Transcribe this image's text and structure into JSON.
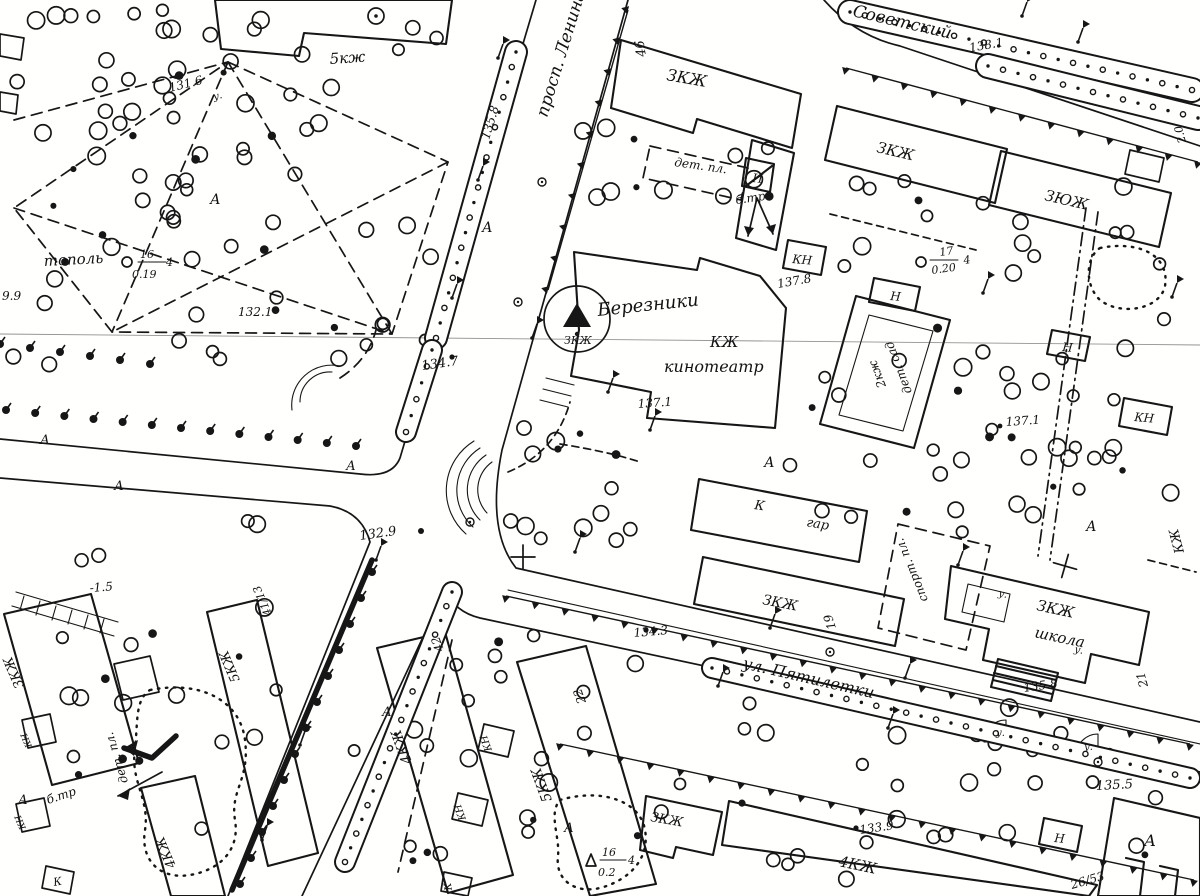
{
  "map": {
    "kind": "scanned topographic city plan (black ink on white paper)",
    "city": "Березники",
    "ink_color": "#161616",
    "paper_color": "#fffffe",
    "streets": [
      "просп. Ленина",
      "Советский",
      "ул. Пятилетки"
    ],
    "landmarks": [
      "КЖ кинотеатр «Березники»",
      "ЗКЖ школа",
      "2кж дет. сад",
      "К гар",
      "дет. пл.",
      "спорт. пл.",
      "б.тр",
      "тополь"
    ],
    "house_numbers": [
      "46",
      "19",
      "21",
      "22",
      "42",
      "41/13",
      "26/53"
    ],
    "spot_elevations": [
      "131.6",
      "132.1",
      "132.9",
      "133.9",
      "134.3",
      "134.7",
      "135.5",
      "135.8",
      "135.8",
      "137.1",
      "137.1",
      "137.8",
      "138.1"
    ],
    "tree_notations": [
      "тополь 16/0.19 4",
      "17/0.20 4",
      "16/0.2 4"
    ],
    "labels": [
      {
        "t": "просп. Ленина",
        "x": 547,
        "y": 118,
        "r": -73,
        "s": 17,
        "n": "street-label-prosp-lenina"
      },
      {
        "t": "Советский",
        "x": 852,
        "y": 16,
        "r": 13,
        "s": 17,
        "n": "street-label-sovetskiy"
      },
      {
        "t": "ул. Пятилетки",
        "x": 742,
        "y": 668,
        "r": 13,
        "s": 16,
        "n": "street-label-ul-pyatiletki"
      },
      {
        "t": "Березники",
        "x": 598,
        "y": 316,
        "r": -6,
        "s": 18,
        "n": "cinema-name-label"
      },
      {
        "t": "КЖ",
        "x": 710,
        "y": 347,
        "r": 0,
        "s": 15,
        "n": "cinema-code-label"
      },
      {
        "t": "кинотеатр",
        "x": 664,
        "y": 372,
        "r": 0,
        "s": 16,
        "n": "cinema-label"
      },
      {
        "t": "ЗКЖ",
        "x": 564,
        "y": 344,
        "r": 0,
        "s": 11,
        "n": "geodetic-point-label"
      },
      {
        "t": "137.1",
        "x": 638,
        "y": 408,
        "r": -4,
        "s": 12,
        "n": "spot-elevation"
      },
      {
        "t": "5кж",
        "x": 330,
        "y": 64,
        "r": -4,
        "s": 15,
        "n": "building-code"
      },
      {
        "t": "131.6",
        "x": 170,
        "y": 92,
        "r": -14,
        "s": 12,
        "n": "spot-elevation"
      },
      {
        "t": "у.",
        "x": 214,
        "y": 100,
        "r": -14,
        "s": 10,
        "n": "surface-mark"
      },
      {
        "t": "тополь",
        "x": 44,
        "y": 266,
        "r": -3,
        "s": 15,
        "n": "tree-species-label"
      },
      {
        "t": "16",
        "x": 140,
        "y": 258,
        "r": 0,
        "s": 11,
        "n": "tree-height"
      },
      {
        "t": "0.19",
        "x": 132,
        "y": 278,
        "r": 0,
        "s": 11,
        "n": "tree-diameter"
      },
      {
        "t": "4",
        "x": 166,
        "y": 266,
        "r": 0,
        "s": 11,
        "n": "tree-spacing"
      },
      {
        "t": "132.1",
        "x": 238,
        "y": 316,
        "r": 0,
        "s": 12,
        "n": "spot-elevation"
      },
      {
        "t": "9.9",
        "x": 2,
        "y": 300,
        "r": 0,
        "s": 12,
        "n": "spot-elevation-partial"
      },
      {
        "t": "А",
        "x": 210,
        "y": 204,
        "r": 0,
        "s": 14,
        "n": "surface-mark-asphalt"
      },
      {
        "t": "46",
        "x": 646,
        "y": 56,
        "r": -100,
        "s": 13,
        "n": "house-number"
      },
      {
        "t": "ЗКЖ",
        "x": 666,
        "y": 80,
        "r": 10,
        "s": 16,
        "n": "building-code"
      },
      {
        "t": "дет. пл.",
        "x": 674,
        "y": 166,
        "r": 8,
        "s": 12,
        "n": "playground-label"
      },
      {
        "t": "б.тр",
        "x": 736,
        "y": 204,
        "r": -8,
        "s": 12,
        "n": "transformer-label"
      },
      {
        "t": "И",
        "x": 752,
        "y": 182,
        "r": 5,
        "s": 12,
        "n": "booth-mark"
      },
      {
        "t": "ЗКЖ",
        "x": 876,
        "y": 152,
        "r": 13,
        "s": 15,
        "n": "building-code"
      },
      {
        "t": "ЗЮЖ",
        "x": 1044,
        "y": 200,
        "r": 13,
        "s": 15,
        "n": "building-code"
      },
      {
        "t": "138.1",
        "x": 970,
        "y": 52,
        "r": -10,
        "s": 12,
        "n": "spot-elevation"
      },
      {
        "t": "КН",
        "x": 792,
        "y": 263,
        "r": 5,
        "s": 12,
        "n": "building-code"
      },
      {
        "t": "137.8",
        "x": 778,
        "y": 288,
        "r": -10,
        "s": 12,
        "n": "spot-elevation"
      },
      {
        "t": "Н",
        "x": 890,
        "y": 300,
        "r": 5,
        "s": 12,
        "n": "building-code"
      },
      {
        "t": "Н",
        "x": 1062,
        "y": 351,
        "r": 5,
        "s": 12,
        "n": "building-code"
      },
      {
        "t": "2кж",
        "x": 886,
        "y": 386,
        "r": -111,
        "s": 12,
        "n": "building-code"
      },
      {
        "t": "дет. сад",
        "x": 912,
        "y": 392,
        "r": -111,
        "s": 12,
        "n": "kindergarten-label"
      },
      {
        "t": "17",
        "x": 940,
        "y": 256,
        "r": -8,
        "s": 11,
        "n": "tree-height"
      },
      {
        "t": "0.20",
        "x": 932,
        "y": 274,
        "r": -8,
        "s": 11,
        "n": "tree-diameter"
      },
      {
        "t": "4",
        "x": 964,
        "y": 264,
        "r": -8,
        "s": 11,
        "n": "tree-spacing"
      },
      {
        "t": "137.1",
        "x": 1006,
        "y": 426,
        "r": -4,
        "s": 12,
        "n": "spot-elevation"
      },
      {
        "t": "КН",
        "x": 1134,
        "y": 421,
        "r": 5,
        "s": 12,
        "n": "building-code"
      },
      {
        "t": "2.0",
        "x": 1186,
        "y": 142,
        "r": -105,
        "s": 11,
        "n": "measure-mark"
      },
      {
        "t": "135.8",
        "x": 489,
        "y": 140,
        "r": -73,
        "s": 12,
        "n": "spot-elevation"
      },
      {
        "t": "134.7",
        "x": 422,
        "y": 370,
        "r": -8,
        "s": 13,
        "n": "spot-elevation"
      },
      {
        "t": "132.9",
        "x": 360,
        "y": 540,
        "r": -8,
        "s": 13,
        "n": "spot-elevation"
      },
      {
        "t": "А",
        "x": 482,
        "y": 232,
        "r": 0,
        "s": 14,
        "n": "surface-mark-asphalt"
      },
      {
        "t": "А",
        "x": 346,
        "y": 470,
        "r": 0,
        "s": 13,
        "n": "surface-mark-asphalt"
      },
      {
        "t": "А",
        "x": 40,
        "y": 444,
        "r": 0,
        "s": 13,
        "n": "surface-mark-asphalt"
      },
      {
        "t": "А",
        "x": 114,
        "y": 490,
        "r": 0,
        "s": 13,
        "n": "surface-mark-asphalt"
      },
      {
        "t": "А",
        "x": 764,
        "y": 467,
        "r": 0,
        "s": 14,
        "n": "surface-mark-asphalt"
      },
      {
        "t": "А",
        "x": 1086,
        "y": 531,
        "r": 0,
        "s": 14,
        "n": "surface-mark-asphalt"
      },
      {
        "t": "А",
        "x": 382,
        "y": 716,
        "r": 0,
        "s": 13,
        "n": "surface-mark-asphalt"
      },
      {
        "t": "А",
        "x": 564,
        "y": 832,
        "r": 0,
        "s": 13,
        "n": "surface-mark-asphalt"
      },
      {
        "t": "А",
        "x": 1144,
        "y": 846,
        "r": 0,
        "s": 16,
        "n": "surface-mark-asphalt"
      },
      {
        "t": "А",
        "x": 18,
        "y": 804,
        "r": 0,
        "s": 13,
        "n": "surface-mark-asphalt"
      },
      {
        "t": "К",
        "x": 754,
        "y": 509,
        "r": 8,
        "s": 13,
        "n": "building-code"
      },
      {
        "t": "гар",
        "x": 806,
        "y": 526,
        "r": 10,
        "s": 13,
        "n": "garage-label"
      },
      {
        "t": "ЗКЖ",
        "x": 762,
        "y": 604,
        "r": 11,
        "s": 14,
        "n": "building-code"
      },
      {
        "t": "19",
        "x": 836,
        "y": 628,
        "r": -108,
        "s": 12,
        "n": "house-number"
      },
      {
        "t": "134.3",
        "x": 634,
        "y": 637,
        "r": -5,
        "s": 12,
        "n": "spot-elevation"
      },
      {
        "t": "спорт. пл.",
        "x": 928,
        "y": 600,
        "r": -112,
        "s": 12,
        "n": "sports-ground-label"
      },
      {
        "t": "ЗКЖ",
        "x": 1036,
        "y": 610,
        "r": 12,
        "s": 15,
        "n": "building-code"
      },
      {
        "t": "школа",
        "x": 1034,
        "y": 637,
        "r": 12,
        "s": 15,
        "n": "school-label"
      },
      {
        "t": "у.",
        "x": 998,
        "y": 596,
        "r": 12,
        "s": 10,
        "n": "surface-mark"
      },
      {
        "t": "у.",
        "x": 1074,
        "y": 652,
        "r": 12,
        "s": 10,
        "n": "surface-mark"
      },
      {
        "t": "135.8",
        "x": 1024,
        "y": 692,
        "r": -8,
        "s": 12,
        "n": "spot-elevation"
      },
      {
        "t": "21",
        "x": 1148,
        "y": 686,
        "r": -105,
        "s": 12,
        "n": "house-number"
      },
      {
        "t": "у.",
        "x": 996,
        "y": 736,
        "r": 0,
        "s": 10,
        "n": "surface-mark"
      },
      {
        "t": "у.",
        "x": 1084,
        "y": 750,
        "r": 0,
        "s": 10,
        "n": "surface-mark"
      },
      {
        "t": "КЖ",
        "x": 1184,
        "y": 552,
        "r": -105,
        "s": 13,
        "n": "building-code"
      },
      {
        "t": "ЗКЖ",
        "x": 650,
        "y": 821,
        "r": 10,
        "s": 13,
        "n": "building-code"
      },
      {
        "t": "4КЖ",
        "x": 838,
        "y": 866,
        "r": 12,
        "s": 15,
        "n": "building-code"
      },
      {
        "t": "133.9",
        "x": 860,
        "y": 834,
        "r": -8,
        "s": 12,
        "n": "spot-elevation"
      },
      {
        "t": "26/53",
        "x": 1072,
        "y": 889,
        "r": -16,
        "s": 12,
        "n": "house-number"
      },
      {
        "t": "135.5",
        "x": 1096,
        "y": 790,
        "r": -3,
        "s": 13,
        "n": "spot-elevation"
      },
      {
        "t": "Н",
        "x": 1054,
        "y": 842,
        "r": 5,
        "s": 12,
        "n": "building-code"
      },
      {
        "t": "5КЖ",
        "x": 552,
        "y": 800,
        "r": -110,
        "s": 14,
        "n": "building-code"
      },
      {
        "t": "22",
        "x": 586,
        "y": 702,
        "r": -110,
        "s": 12,
        "n": "house-number"
      },
      {
        "t": "4КЖ",
        "x": 412,
        "y": 762,
        "r": -110,
        "s": 14,
        "n": "building-code"
      },
      {
        "t": "42",
        "x": 444,
        "y": 650,
        "r": -110,
        "s": 12,
        "n": "house-number"
      },
      {
        "t": "КН",
        "x": 492,
        "y": 750,
        "r": -110,
        "s": 10,
        "n": "building-code"
      },
      {
        "t": "КН",
        "x": 466,
        "y": 819,
        "r": -110,
        "s": 10,
        "n": "building-code"
      },
      {
        "t": "К",
        "x": 452,
        "y": 890,
        "r": -100,
        "s": 10,
        "n": "building-code"
      },
      {
        "t": "16",
        "x": 602,
        "y": 856,
        "r": 0,
        "s": 11,
        "n": "tree-height"
      },
      {
        "t": "0.2",
        "x": 598,
        "y": 876,
        "r": 0,
        "s": 11,
        "n": "tree-diameter"
      },
      {
        "t": "4",
        "x": 628,
        "y": 864,
        "r": 0,
        "s": 11,
        "n": "tree-spacing"
      },
      {
        "t": "5КЖ",
        "x": 240,
        "y": 680,
        "r": -113,
        "s": 13,
        "n": "building-code"
      },
      {
        "t": "41/13",
        "x": 272,
        "y": 614,
        "r": -113,
        "s": 11,
        "n": "house-number"
      },
      {
        "t": "ЗКЖ",
        "x": 24,
        "y": 686,
        "r": -113,
        "s": 13,
        "n": "building-code"
      },
      {
        "t": "-1.5",
        "x": 90,
        "y": 592,
        "r": -4,
        "s": 12,
        "n": "embankment-height"
      },
      {
        "t": "дет. пл.",
        "x": 128,
        "y": 782,
        "r": -107,
        "s": 12,
        "n": "playground-label"
      },
      {
        "t": "б.тр",
        "x": 48,
        "y": 804,
        "r": -18,
        "s": 12,
        "n": "transformer-label"
      },
      {
        "t": "4КЖ",
        "x": 176,
        "y": 866,
        "r": -113,
        "s": 13,
        "n": "building-code"
      },
      {
        "t": "КН",
        "x": 32,
        "y": 746,
        "r": -113,
        "s": 9,
        "n": "building-code"
      },
      {
        "t": "КН",
        "x": 26,
        "y": 828,
        "r": -113,
        "s": 9,
        "n": "building-code"
      },
      {
        "t": "К",
        "x": 54,
        "y": 886,
        "r": -10,
        "s": 11,
        "n": "building-code"
      }
    ]
  }
}
